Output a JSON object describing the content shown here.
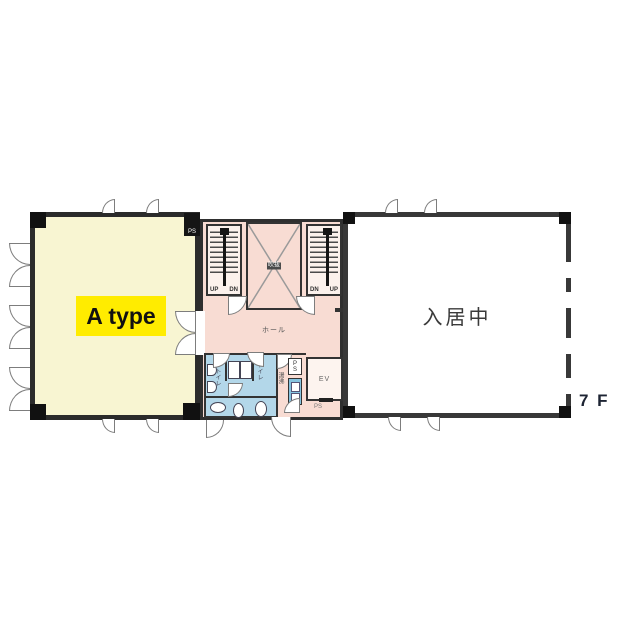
{
  "floor": {
    "label": "7 F"
  },
  "rooms": {
    "a_type": {
      "label": "A type"
    },
    "occupied": {
      "label": "入居中"
    },
    "hall": {
      "label": "ホール"
    },
    "void_shaft": {
      "label": "吹抜"
    },
    "kitchenette": {
      "label": "湯沸"
    },
    "elevator": {
      "label": "EV"
    },
    "toilet_left": {
      "label": "トイレ"
    },
    "toilet_right": {
      "label": "トイレ"
    }
  },
  "pipe_spaces": {
    "top": "PS",
    "middle": "PS",
    "bottom": "PS"
  },
  "stairs": {
    "left": {
      "up": "UP",
      "dn": "DN"
    },
    "right": {
      "dn": "DN",
      "up": "UP"
    }
  },
  "colors": {
    "wall": "#2e2e2e",
    "a_type_fill": "#f8f5d2",
    "a_type_label_bg": "#ffec00",
    "core_pink": "#f8dcd3",
    "toilet_blue": "#b3d7e9",
    "sink_blue": "#85c3df",
    "occupied_fill": "#ffffff"
  }
}
